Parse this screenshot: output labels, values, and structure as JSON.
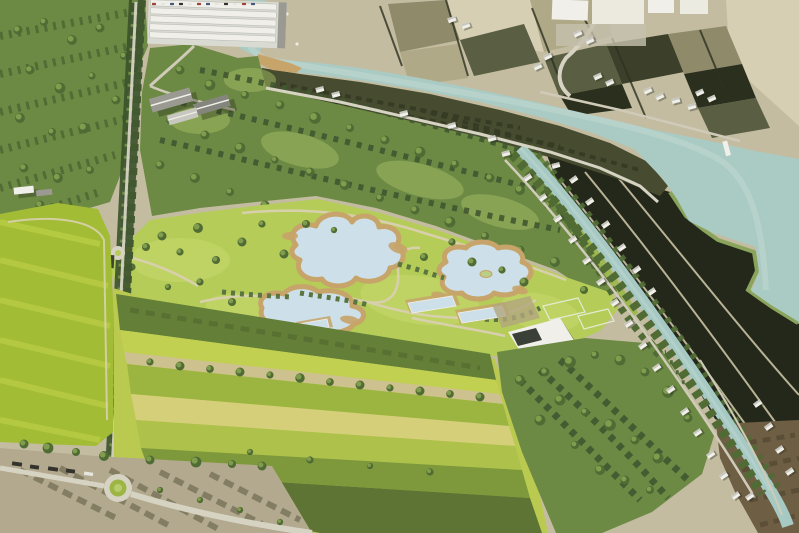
{
  "scene": {
    "type": "aerial-rendering",
    "description": "Bird's-eye architectural rendering of a landscape park design set in river farmland: a meandering river at top, a new park with three swimming ponds and lap pools, a long tree-lined avenue, striped crop fields, dense woods, and a canal lined with small white houses running to the lower right",
    "counts": {
      "swimming_ponds": 3,
      "lap_pools": 3,
      "roundabouts": 2
    },
    "features": [
      {
        "id": "river",
        "label": "Meandering river"
      },
      {
        "id": "river-meander",
        "label": "River bend with sandy point bar"
      },
      {
        "id": "canal",
        "label": "Canal with houses"
      },
      {
        "id": "swimming-ponds",
        "label": "Swimming ponds with sand edges"
      },
      {
        "id": "lap-pools",
        "label": "Rectangular lap pools with decks"
      },
      {
        "id": "park-lawn",
        "label": "Park meadow"
      },
      {
        "id": "tree-lined-avenue",
        "label": "Tree-lined avenue"
      },
      {
        "id": "central-forest",
        "label": "Central woodland"
      },
      {
        "id": "forest-triangle",
        "label": "South-east woodland"
      },
      {
        "id": "orchard-rows",
        "label": "Orchard rows"
      },
      {
        "id": "striped-fields",
        "label": "Striped crop fields"
      },
      {
        "id": "left-field",
        "label": "Western pasture"
      },
      {
        "id": "greenhouse-complex",
        "label": "Greenhouse complex"
      },
      {
        "id": "farm-barns",
        "label": "Farm barns"
      },
      {
        "id": "industrial-buildings",
        "label": "Industrial buildings"
      },
      {
        "id": "dark-plowed-fields",
        "label": "Dark plowed plots"
      },
      {
        "id": "existing-farmland",
        "label": "Existing sepia farmland"
      },
      {
        "id": "park-building",
        "label": "Park pavilion"
      },
      {
        "id": "sports-courts",
        "label": "Sports courts"
      },
      {
        "id": "roundabout-main",
        "label": "Roundabout"
      },
      {
        "id": "brown-field",
        "label": "Bare brown field"
      }
    ],
    "palette": {
      "river": "#a9cbc4",
      "riverHi": "#cfe0da",
      "canal": "#a7c9c4",
      "pond": "#cddfe8",
      "pondHi": "#eaf2f5",
      "sand": "#c7a469",
      "sepiaBase": "#c3bca1",
      "sepiaLight": "#d6cfb4",
      "swField": "#b2a98e",
      "plotMid": "#8e8a6a",
      "plotOlive": "#5a5e42",
      "plotDark": "#3c402b",
      "plotDarker": "#2b2f1e",
      "plotPale": "#afa987",
      "hedge": "#2e3222",
      "sepiaRow": "#56523c",
      "white": "#f0efe9",
      "roofGray": "#9a9a92",
      "roofLight": "#c7c7bf",
      "glass": "#3a4038",
      "darkField": "#24281a",
      "fieldPath": "#c9c2a4",
      "greenEdge": "#8aa45c",
      "brownField": "#6e5e44",
      "brownDark": "#50452f",
      "riparian": "#474c30",
      "riparianDark": "#343a22",
      "forest": "#6d8a45",
      "forestDark": "#516b35",
      "forestDarker": "#415830",
      "forestLight": "#8fae56",
      "canopyLight": "#a3bd62",
      "treeRow": "#4f673a",
      "shrub": "#5a7540",
      "lawn": "#b5cc58",
      "lawnLight": "#c7d96d",
      "parkGreen": "#9db84c",
      "fieldBase": "#bac94f",
      "bandDark": "#647f38",
      "bandBright": "#c2d052",
      "bandTan": "#cdc28f",
      "bandGreen": "#9cb541",
      "bandYellow": "#d5cf7a",
      "bandMid": "#aec14b",
      "bandDeep": "#7e993c",
      "bandBottom": "#5d7435",
      "leftField": "#a2bc35",
      "leftFieldLight": "#b9cd45",
      "road": "#d6d3c3",
      "roadMinor": "#cfcbb8",
      "pathTan": "#d8d0ad",
      "court": "#8fb94e",
      "courtLine": "#e4ead0",
      "orchardGround": "#b2a67d",
      "parking": "#3f4430",
      "truck": "#33332c",
      "carA": "#9c4538",
      "carB": "#46597e",
      "carC": "#e6e6df",
      "island": "#b9cf86"
    }
  }
}
